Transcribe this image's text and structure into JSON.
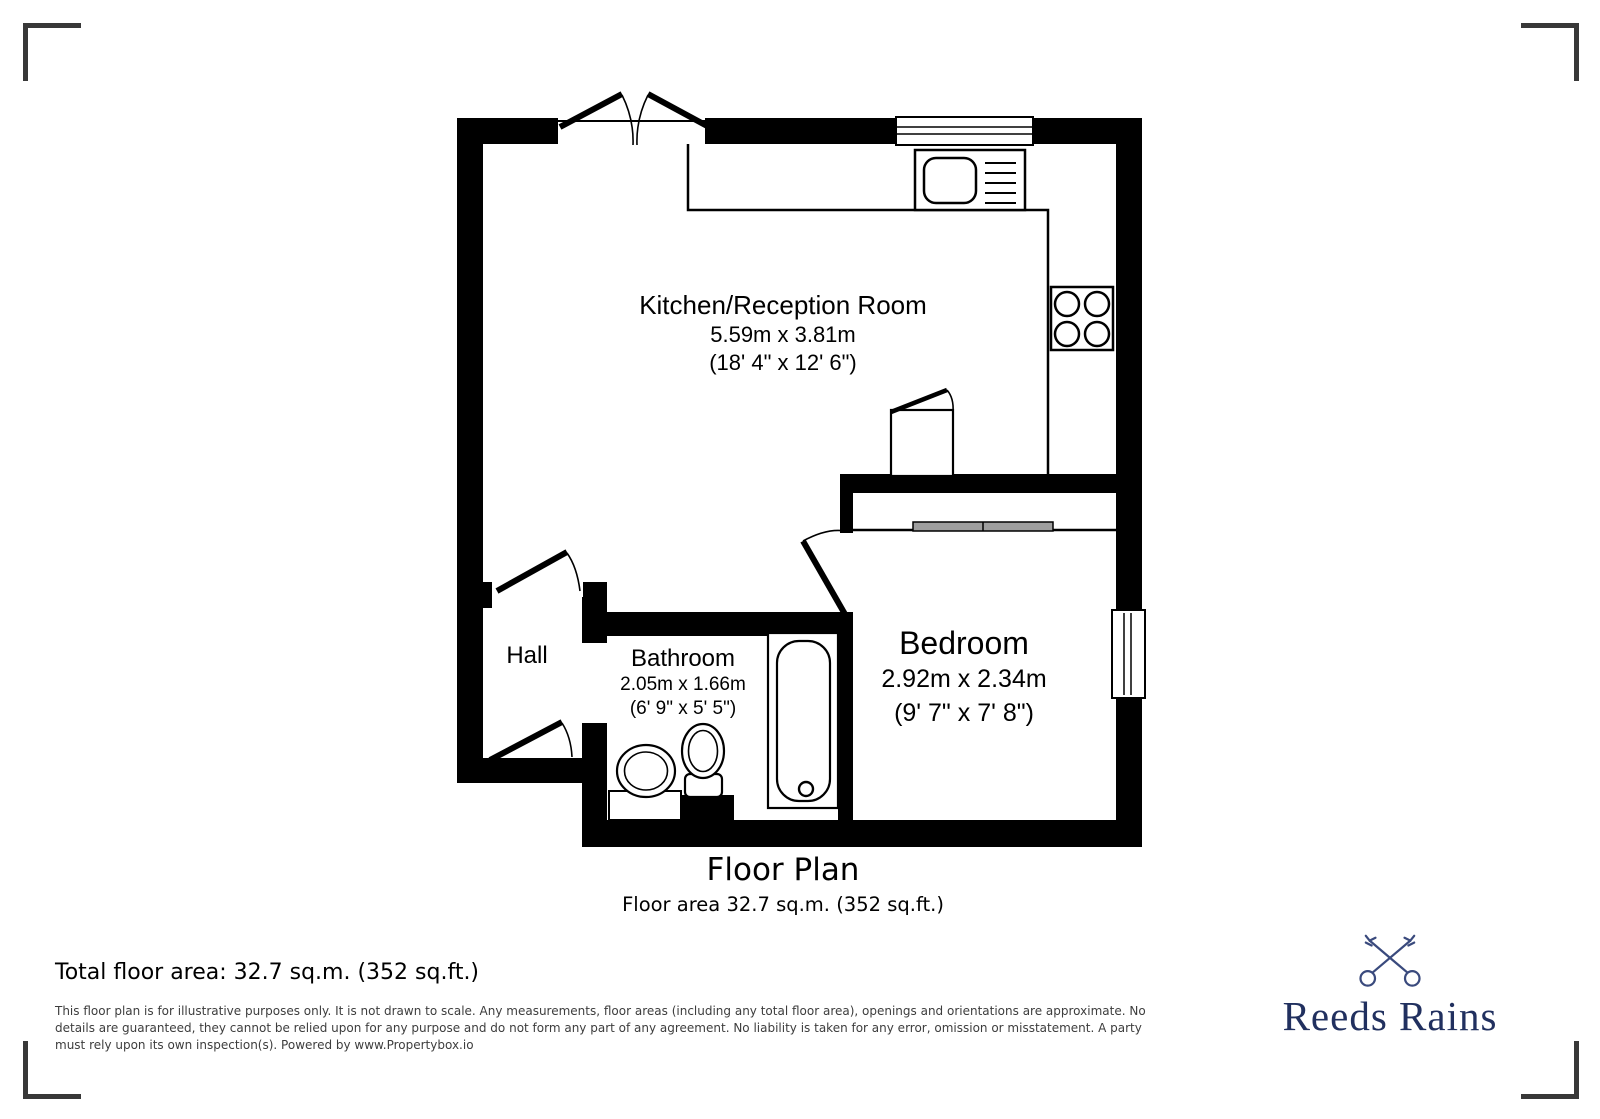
{
  "plan": {
    "rooms": {
      "kitchen": {
        "name": "Kitchen/Reception Room",
        "metric": "5.59m x 3.81m",
        "imperial": "(18' 4\" x 12' 6\")"
      },
      "hall": {
        "name": "Hall"
      },
      "bathroom": {
        "name": "Bathroom",
        "metric": "2.05m x 1.66m",
        "imperial": "(6' 9\" x 5' 5\")"
      },
      "bedroom": {
        "name": "Bedroom",
        "metric": "2.92m x 2.34m",
        "imperial": "(9' 7\" x 7' 8\")"
      }
    },
    "fixture_icons": [
      "sink-unit-icon",
      "hob-icon",
      "cupboard-icon",
      "bath-icon",
      "toilet-icon",
      "basin-icon",
      "wardrobe-icon",
      "window-icon",
      "door-swing-icon"
    ]
  },
  "caption": {
    "title": "Floor Plan",
    "subtitle": "Floor area 32.7 sq.m. (352 sq.ft.)"
  },
  "footer": {
    "total_area": "Total floor area: 32.7 sq.m. (352 sq.ft.)",
    "disclaimer_lines": [
      "This floor plan is for illustrative purposes only. It is not drawn to scale. Any measurements, floor areas (including any total floor area), openings and orientations are approximate. No",
      "details are guaranteed, they cannot be relied upon for any purpose and do not form any part of any agreement. No liability is taken for any error, omission or misstatement. A party",
      "must rely upon its own inspection(s). Powered by www.Propertybox.io"
    ],
    "brand_name": "Reeds Rains"
  },
  "colors": {
    "wall": "#000000",
    "disclaimer_text": "#3d3d3d",
    "corner_mark": "#383838",
    "brand_navy": "#21305f",
    "keys_navy": "#3a4a7d",
    "wardrobe_gray": "#9e9e9e"
  }
}
